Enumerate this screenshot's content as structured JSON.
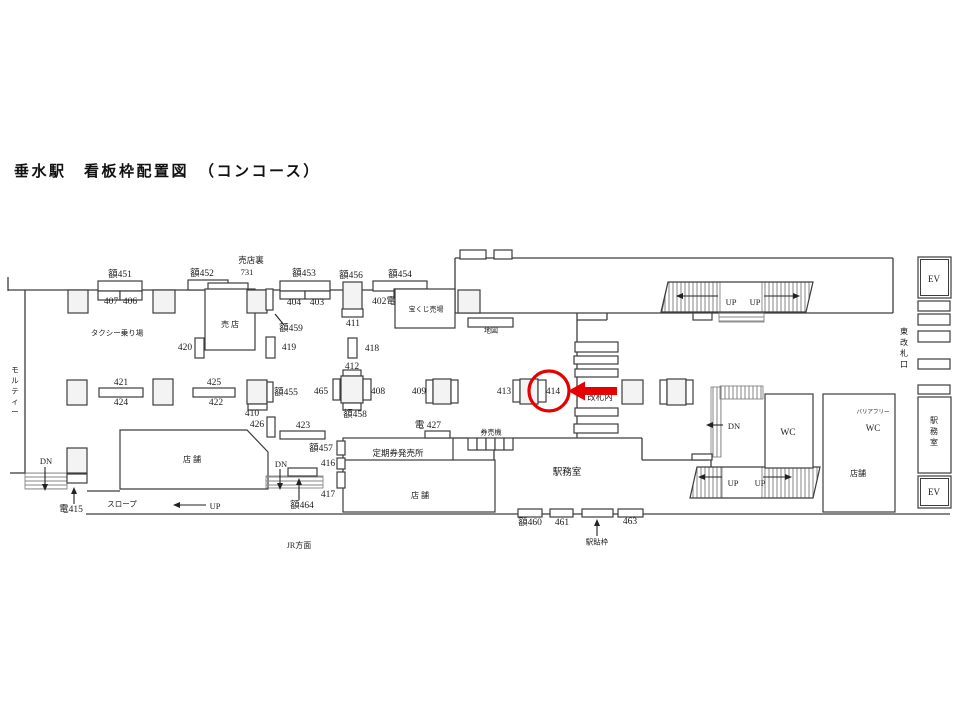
{
  "title": "垂水駅　看板枠配置図　（コンコース）",
  "diagram": {
    "wall_color": "#3d3d3d",
    "pillar_fill": "#f3f3f3",
    "lines": [
      [
        8,
        277,
        8,
        291
      ],
      [
        8,
        290,
        455,
        290
      ],
      [
        25,
        290,
        25,
        474
      ],
      [
        10,
        473,
        25,
        473
      ],
      [
        455,
        258,
        455,
        313
      ],
      [
        455,
        258,
        893,
        258
      ],
      [
        893,
        258,
        893,
        313
      ],
      [
        455,
        313,
        893,
        313
      ],
      [
        577,
        313,
        577,
        438
      ],
      [
        577,
        320,
        607,
        320
      ],
      [
        607,
        313,
        607,
        320
      ],
      [
        453,
        438,
        468,
        438
      ],
      [
        513,
        438,
        642,
        438
      ],
      [
        642,
        438,
        642,
        460
      ],
      [
        642,
        460,
        708,
        460
      ],
      [
        494,
        450,
        494,
        511
      ],
      [
        86,
        514,
        950,
        514
      ],
      [
        87,
        491,
        120,
        491
      ],
      [
        711,
        457,
        711,
        467
      ],
      [
        823,
        438,
        895,
        438
      ],
      [
        852,
        394,
        852,
        438
      ]
    ],
    "polys": [
      {
        "n": "shop-left",
        "pts": "120,430 247,430 268,452 268,489 120,489",
        "f": "w"
      },
      {
        "n": "stairs-top-hatch-left",
        "pts": "668,282 720,282 720,312 662,312",
        "f": "hv"
      },
      {
        "n": "stairs-top-hatch-right",
        "pts": "762,282 813,282 806,312 762,312",
        "f": "hv"
      },
      {
        "n": "stairs-top-outline",
        "pts": "668,282 813,282 806,312 661,312",
        "f": "n"
      },
      {
        "n": "stairs-bottom-hatch-left",
        "pts": "697,467 722,467 722,498 690,498",
        "f": "hv"
      },
      {
        "n": "stairs-bottom-hatch-right",
        "pts": "762,467 820,467 813,498 762,498",
        "f": "hv"
      },
      {
        "n": "stairs-bottom-outline",
        "pts": "697,467 820,467 813,498 690,498",
        "f": "n"
      }
    ],
    "boxes": [
      [
        "hatch-stairs-under-band",
        719,
        313,
        45,
        9,
        "hh"
      ],
      [
        "hatch-dn-band-right",
        720,
        386,
        43,
        13,
        "hv"
      ],
      [
        "hatch-dn-strip-right",
        711,
        387,
        10,
        70,
        "hv"
      ],
      [
        "hatch-dn-ramp-left",
        25,
        473,
        42,
        16,
        "hh"
      ],
      [
        "hatch-dn-ramp-center",
        266,
        476,
        57,
        12,
        "hh"
      ],
      [
        "frame-451",
        98,
        281,
        44,
        10
      ],
      [
        "frame-407",
        98,
        291,
        22,
        9
      ],
      [
        "frame-406",
        120,
        291,
        22,
        9
      ],
      [
        "frame-452",
        188,
        280,
        40,
        10
      ],
      [
        "frame-731",
        208,
        283,
        40,
        8
      ],
      [
        "frame-453",
        280,
        281,
        50,
        10
      ],
      [
        "frame-404",
        280,
        291,
        25,
        8
      ],
      [
        "frame-403",
        305,
        291,
        25,
        8
      ],
      [
        "frame-454",
        373,
        281,
        54,
        10
      ],
      [
        "frame-402",
        394,
        289,
        33,
        9
      ],
      [
        "pillar-456",
        343,
        282,
        19,
        28,
        "g"
      ],
      [
        "frame-411",
        342,
        309,
        21,
        8
      ],
      [
        "wall-pillar-1",
        68,
        290,
        20,
        23,
        "g"
      ],
      [
        "wall-pillar-2",
        153,
        290,
        22,
        23,
        "g"
      ],
      [
        "wall-pillar-3",
        458,
        290,
        22,
        23,
        "g"
      ],
      [
        "kiosk",
        205,
        289,
        50,
        61
      ],
      [
        "kiosk-pillar",
        247,
        290,
        20,
        23,
        "g"
      ],
      [
        "frame-459",
        266,
        289,
        7,
        21
      ],
      [
        "lottery-booth",
        395,
        289,
        60,
        39
      ],
      [
        "map-frame",
        468,
        318,
        45,
        9
      ],
      [
        "overpass-tab-1",
        460,
        250,
        26,
        9
      ],
      [
        "overpass-tab-2",
        494,
        250,
        18,
        9
      ],
      [
        "frame-420",
        195,
        338,
        9,
        20
      ],
      [
        "frame-419",
        266,
        337,
        9,
        21
      ],
      [
        "frame-418",
        348,
        338,
        9,
        20
      ],
      [
        "pillar-mid-1",
        67,
        380,
        20,
        25,
        "g"
      ],
      [
        "pillar-mid-2",
        153,
        379,
        20,
        26,
        "g"
      ],
      [
        "frame-421",
        99,
        388,
        44,
        9
      ],
      [
        "frame-425",
        193,
        388,
        42,
        9
      ],
      [
        "pillar-455",
        247,
        380,
        20,
        24,
        "g"
      ],
      [
        "panel-455",
        267,
        382,
        6,
        20
      ],
      [
        "frame-410",
        248,
        404,
        19,
        6
      ],
      [
        "frame-426",
        267,
        417,
        8,
        20
      ],
      [
        "frame-423",
        280,
        431,
        45,
        8
      ],
      [
        "frame-412",
        343,
        370,
        18,
        6
      ],
      [
        "pillar-412",
        341,
        376,
        22,
        27,
        "g"
      ],
      [
        "frame-465",
        333,
        379,
        7,
        21
      ],
      [
        "frame-408",
        363,
        379,
        8,
        21
      ],
      [
        "frame-458",
        343,
        403,
        18,
        7
      ],
      [
        "frame-409-left",
        426,
        380,
        7,
        23
      ],
      [
        "pillar-409",
        433,
        379,
        18,
        25,
        "g"
      ],
      [
        "frame-409-right",
        451,
        380,
        7,
        23
      ],
      [
        "frame-413",
        513,
        380,
        7,
        22
      ],
      [
        "pillar-413",
        520,
        379,
        18,
        25,
        "g"
      ],
      [
        "frame-414",
        538,
        380,
        8,
        22
      ],
      [
        "pillar-mid-7",
        622,
        380,
        21,
        24,
        "g"
      ],
      [
        "frame-east-left",
        660,
        380,
        7,
        24
      ],
      [
        "pillar-mid-8",
        667,
        379,
        19,
        26,
        "g"
      ],
      [
        "frame-east-right",
        686,
        380,
        7,
        24
      ],
      [
        "stair-bar-1",
        575,
        342,
        43,
        10
      ],
      [
        "stair-bar-2",
        574,
        356,
        44,
        8
      ],
      [
        "stair-bar-3",
        575,
        369,
        43,
        8
      ],
      [
        "stair-bar-4",
        575,
        408,
        43,
        8
      ],
      [
        "stair-bar-5",
        574,
        424,
        44,
        9
      ],
      [
        "under-band-tab",
        693,
        313,
        19,
        7
      ],
      [
        "mid-right-tab",
        692,
        454,
        20,
        6
      ],
      [
        "pass-office",
        343,
        438,
        110,
        32
      ],
      [
        "shop-center",
        343,
        460,
        152,
        52
      ],
      [
        "ticket-machine-1",
        468,
        438,
        9,
        12
      ],
      [
        "ticket-machine-2",
        477,
        438,
        9,
        12
      ],
      [
        "ticket-machine-3",
        486,
        438,
        9,
        12
      ],
      [
        "ticket-machine-4",
        495,
        438,
        9,
        12
      ],
      [
        "ticket-machine-5",
        504,
        438,
        9,
        12
      ],
      [
        "frame-427",
        425,
        431,
        25,
        7
      ],
      [
        "frame-457",
        337,
        441,
        8,
        14
      ],
      [
        "frame-416",
        337,
        458,
        8,
        11
      ],
      [
        "frame-417",
        337,
        472,
        8,
        16
      ],
      [
        "frame-464",
        288,
        468,
        29,
        8
      ],
      [
        "pillar-bottom-left",
        67,
        448,
        20,
        25,
        "g"
      ],
      [
        "frame-415",
        67,
        474,
        20,
        9
      ],
      [
        "frame-460",
        518,
        509,
        24,
        8
      ],
      [
        "frame-461",
        550,
        509,
        23,
        8
      ],
      [
        "frame-poster",
        582,
        509,
        31,
        8
      ],
      [
        "frame-463",
        618,
        509,
        25,
        8
      ],
      [
        "wc-room",
        765,
        394,
        48,
        74
      ],
      [
        "right-block",
        823,
        394,
        72,
        118
      ],
      [
        "station-office-right",
        918,
        397,
        33,
        76
      ],
      [
        "ev-top",
        918,
        257,
        33,
        41,
        "w",
        1
      ],
      [
        "ev-bottom",
        918,
        476,
        33,
        32,
        "w",
        1
      ],
      [
        "gate-bar-1",
        918,
        301,
        32,
        10
      ],
      [
        "gate-bar-2",
        918,
        314,
        32,
        11
      ],
      [
        "gate-bar-3",
        918,
        331,
        32,
        11
      ],
      [
        "gate-bar-4",
        918,
        359,
        32,
        10
      ],
      [
        "gate-bar-5",
        918,
        385,
        32,
        9
      ]
    ],
    "labels": [
      {
        "t": "額451",
        "x": 120,
        "y": 275
      },
      {
        "t": "407",
        "x": 111,
        "y": 302
      },
      {
        "t": "406",
        "x": 130,
        "y": 302
      },
      {
        "t": "額452",
        "x": 202,
        "y": 274
      },
      {
        "t": "売店裏",
        "x": 251,
        "y": 261,
        "s": 8.5
      },
      {
        "t": "731",
        "x": 247,
        "y": 273,
        "s": 8.5
      },
      {
        "t": "額453",
        "x": 304,
        "y": 274
      },
      {
        "t": "404",
        "x": 294,
        "y": 303
      },
      {
        "t": "403",
        "x": 317,
        "y": 303
      },
      {
        "t": "額456",
        "x": 351,
        "y": 276
      },
      {
        "t": "411",
        "x": 353,
        "y": 324
      },
      {
        "t": "額454",
        "x": 400,
        "y": 275
      },
      {
        "t": "402電",
        "x": 384,
        "y": 302
      },
      {
        "t": "宝くじ売場",
        "x": 426,
        "y": 310,
        "s": 7
      },
      {
        "t": "地図",
        "x": 491,
        "y": 331,
        "s": 7
      },
      {
        "t": "タクシー乗り場",
        "x": 117,
        "y": 334,
        "s": 7.5
      },
      {
        "t": "売 店",
        "x": 230,
        "y": 325,
        "s": 8
      },
      {
        "t": "額459",
        "x": 291,
        "y": 329
      },
      {
        "t": "420",
        "x": 185,
        "y": 348
      },
      {
        "t": "419",
        "x": 289,
        "y": 348
      },
      {
        "t": "418",
        "x": 372,
        "y": 349
      },
      {
        "t": "412",
        "x": 352,
        "y": 367
      },
      {
        "t": "421",
        "x": 121,
        "y": 383
      },
      {
        "t": "424",
        "x": 121,
        "y": 403
      },
      {
        "t": "425",
        "x": 214,
        "y": 383
      },
      {
        "t": "422",
        "x": 216,
        "y": 403
      },
      {
        "t": "額455",
        "x": 286,
        "y": 393
      },
      {
        "t": "465",
        "x": 321,
        "y": 392
      },
      {
        "t": "408",
        "x": 378,
        "y": 392
      },
      {
        "t": "額458",
        "x": 355,
        "y": 415
      },
      {
        "t": "410",
        "x": 252,
        "y": 414
      },
      {
        "t": "426",
        "x": 257,
        "y": 425
      },
      {
        "t": "423",
        "x": 303,
        "y": 426
      },
      {
        "t": "409",
        "x": 419,
        "y": 392
      },
      {
        "t": "413",
        "x": 504,
        "y": 392
      },
      {
        "t": "414",
        "x": 553,
        "y": 392
      },
      {
        "t": "電 427",
        "x": 428,
        "y": 426
      },
      {
        "t": "券売機",
        "x": 491,
        "y": 433,
        "s": 7
      },
      {
        "t": "定期券発売所",
        "x": 398,
        "y": 454,
        "s": 8.5
      },
      {
        "t": "店 舗",
        "x": 420,
        "y": 496,
        "s": 8
      },
      {
        "t": "駅務室",
        "x": 567,
        "y": 473
      },
      {
        "t": "額457",
        "x": 321,
        "y": 449
      },
      {
        "t": "416",
        "x": 328,
        "y": 464
      },
      {
        "t": "417",
        "x": 328,
        "y": 495
      },
      {
        "t": "DN",
        "x": 281,
        "y": 465,
        "s": 8.5
      },
      {
        "t": "額464",
        "x": 302,
        "y": 506
      },
      {
        "t": "DN",
        "x": 46,
        "y": 462,
        "s": 8.5
      },
      {
        "t": "電415",
        "x": 71,
        "y": 510
      },
      {
        "t": "スロープ",
        "x": 122,
        "y": 505,
        "s": 7.5
      },
      {
        "t": "UP",
        "x": 215,
        "y": 507,
        "s": 8.5
      },
      {
        "t": "店 舗",
        "x": 192,
        "y": 460,
        "s": 8
      },
      {
        "t": "JR方面",
        "x": 299,
        "y": 546,
        "s": 8
      },
      {
        "t": "額460",
        "x": 530,
        "y": 523
      },
      {
        "t": "461",
        "x": 562,
        "y": 523
      },
      {
        "t": "463",
        "x": 630,
        "y": 522
      },
      {
        "t": "駅貼枠",
        "x": 597,
        "y": 543,
        "s": 7.5
      },
      {
        "t": "UP",
        "x": 731,
        "y": 303,
        "s": 8.5
      },
      {
        "t": "UP",
        "x": 755,
        "y": 303,
        "s": 8.5
      },
      {
        "t": "DN",
        "x": 734,
        "y": 427,
        "s": 8.5
      },
      {
        "t": "UP",
        "x": 733,
        "y": 484,
        "s": 8.5
      },
      {
        "t": "UP",
        "x": 760,
        "y": 484,
        "s": 8.5
      },
      {
        "t": "WC",
        "x": 788,
        "y": 433
      },
      {
        "t": "バリアフリー",
        "x": 873,
        "y": 412,
        "s": 5.5
      },
      {
        "t": "WC",
        "x": 873,
        "y": 429,
        "s": 9
      },
      {
        "t": "店舗",
        "x": 858,
        "y": 474,
        "s": 8
      },
      {
        "t": "EV",
        "x": 934,
        "y": 280,
        "s": 9
      },
      {
        "t": "EV",
        "x": 934,
        "y": 493,
        "s": 9
      },
      {
        "t": "東改札口",
        "x": 904,
        "y": 332,
        "s": 8,
        "v": 1
      },
      {
        "t": "駅務室",
        "x": 934,
        "y": 421,
        "s": 8,
        "v": 1
      },
      {
        "t": "モルティー",
        "x": 15,
        "y": 371,
        "s": 7.5,
        "v": 1
      }
    ],
    "arrows": [
      [
        284,
        325,
        271,
        310
      ],
      [
        45,
        467,
        45,
        491
      ],
      [
        74,
        504,
        74,
        487
      ],
      [
        206,
        505,
        173,
        505
      ],
      [
        280,
        469,
        280,
        490
      ],
      [
        299,
        500,
        299,
        478
      ],
      [
        597,
        536,
        597,
        519
      ],
      [
        718,
        296,
        676,
        296
      ],
      [
        764,
        296,
        800,
        296
      ],
      [
        723,
        425,
        706,
        425
      ],
      [
        722,
        477,
        698,
        477
      ],
      [
        763,
        477,
        792,
        477
      ]
    ],
    "highlight": {
      "color": "#e60000",
      "circle": {
        "cx": 549,
        "cy": 391,
        "r": 20
      },
      "arrow": {
        "tip_x": 568,
        "tail_x": 617,
        "y": 391,
        "shaft_h": 8,
        "head_h": 19,
        "head_l": 17
      },
      "back_label": {
        "t": "改札内",
        "x": 600,
        "y": 398,
        "s": 8.5
      }
    }
  }
}
